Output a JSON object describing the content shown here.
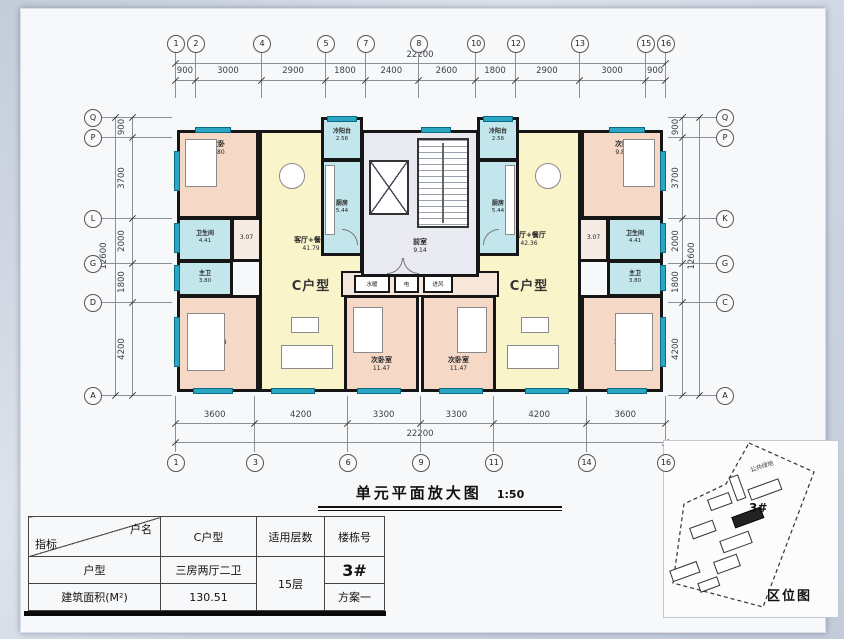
{
  "title": {
    "text": "单元平面放大图",
    "scale": "1:50"
  },
  "grid": {
    "top": {
      "total": "22200",
      "segments": [
        "900",
        "3000",
        "2900",
        "1800",
        "2400",
        "2600",
        "1800",
        "2900",
        "3000",
        "900"
      ],
      "bubbles": [
        "1",
        "2",
        "4",
        "5",
        "7",
        "8",
        "10",
        "12",
        "13",
        "15",
        "16"
      ]
    },
    "bottom": {
      "total": "22200",
      "segments": [
        "3600",
        "4200",
        "3300",
        "3300",
        "4200",
        "3600"
      ],
      "bubbles": [
        "1",
        "3",
        "6",
        "9",
        "11",
        "14",
        "16"
      ]
    },
    "left": {
      "total": "12600",
      "segments": [
        "900",
        "3700",
        "2000",
        "1800",
        "4200"
      ],
      "bubbles": [
        "Q",
        "P",
        "L",
        "G",
        "D",
        "A"
      ]
    },
    "right": {
      "total": "12600",
      "segments": [
        "900",
        "3700",
        "2000",
        "1800",
        "4200"
      ],
      "bubbles": [
        "Q",
        "P",
        "K",
        "G",
        "C",
        "A"
      ]
    }
  },
  "plan": {
    "left_unit": {
      "type": "C户型",
      "living": {
        "name": "客厅+餐厅",
        "area": "41.79"
      },
      "bedroom_top": {
        "name": "次卧",
        "area": "9.80"
      },
      "bedroom_second": {
        "name": "次卧室",
        "area": "11.47"
      },
      "bedroom_master": {
        "name": "主卧",
        "area": "15.68"
      },
      "bath": {
        "name": "卫生间",
        "area": "4.41"
      },
      "master_bath": {
        "name": "主卫",
        "area": "3.80"
      },
      "hall": {
        "area": "3.07"
      },
      "kitchen": {
        "name": "厨房",
        "area": "5.44"
      },
      "balcony": {
        "name": "冷阳台",
        "area": "2.56"
      }
    },
    "right_unit": {
      "type": "C户型",
      "living": {
        "name": "客厅+餐厅",
        "area": "42.36"
      },
      "bedroom_top": {
        "name": "次卧",
        "area": "9.80"
      },
      "bedroom_second": {
        "name": "次卧室",
        "area": "11.47"
      },
      "bedroom_master": {
        "name": "主卧",
        "area": "15.52"
      },
      "bath": {
        "name": "卫生间",
        "area": "4.41"
      },
      "master_bath": {
        "name": "主卫",
        "area": "3.80"
      },
      "hall": {
        "area": "3.07"
      },
      "kitchen": {
        "name": "厨房",
        "area": "5.44"
      },
      "balcony": {
        "name": "冷阳台",
        "area": "2.56"
      }
    },
    "core": {
      "front_room": {
        "name": "前室",
        "area": "9.14"
      },
      "shafts": [
        {
          "name": "水暖"
        },
        {
          "name": "电"
        },
        {
          "name": "进风"
        }
      ]
    }
  },
  "table": {
    "corner_top": "户名",
    "corner_bottom": "指标",
    "col_unit": "C户型",
    "col_floors": "适用层数",
    "col_building": "楼栋号",
    "row_type_label": "户型",
    "row_type_value": "三房两厅二卫",
    "floors_value": "15层",
    "building_value": "3#",
    "row_area_label": "建筑面积(M²)",
    "area_value": "130.51",
    "scheme_value": "方案一"
  },
  "map": {
    "label": "区位图",
    "building_label": "3#",
    "green_label": "公共绿地"
  },
  "colors": {
    "wall": "#161616",
    "bedroom": "#f6d8c6",
    "living": "#faf4cb",
    "wet": "#c3e6ec",
    "core": "#e9e9f1",
    "corridor": "#f6e7da",
    "window": "#2ba7c4"
  }
}
